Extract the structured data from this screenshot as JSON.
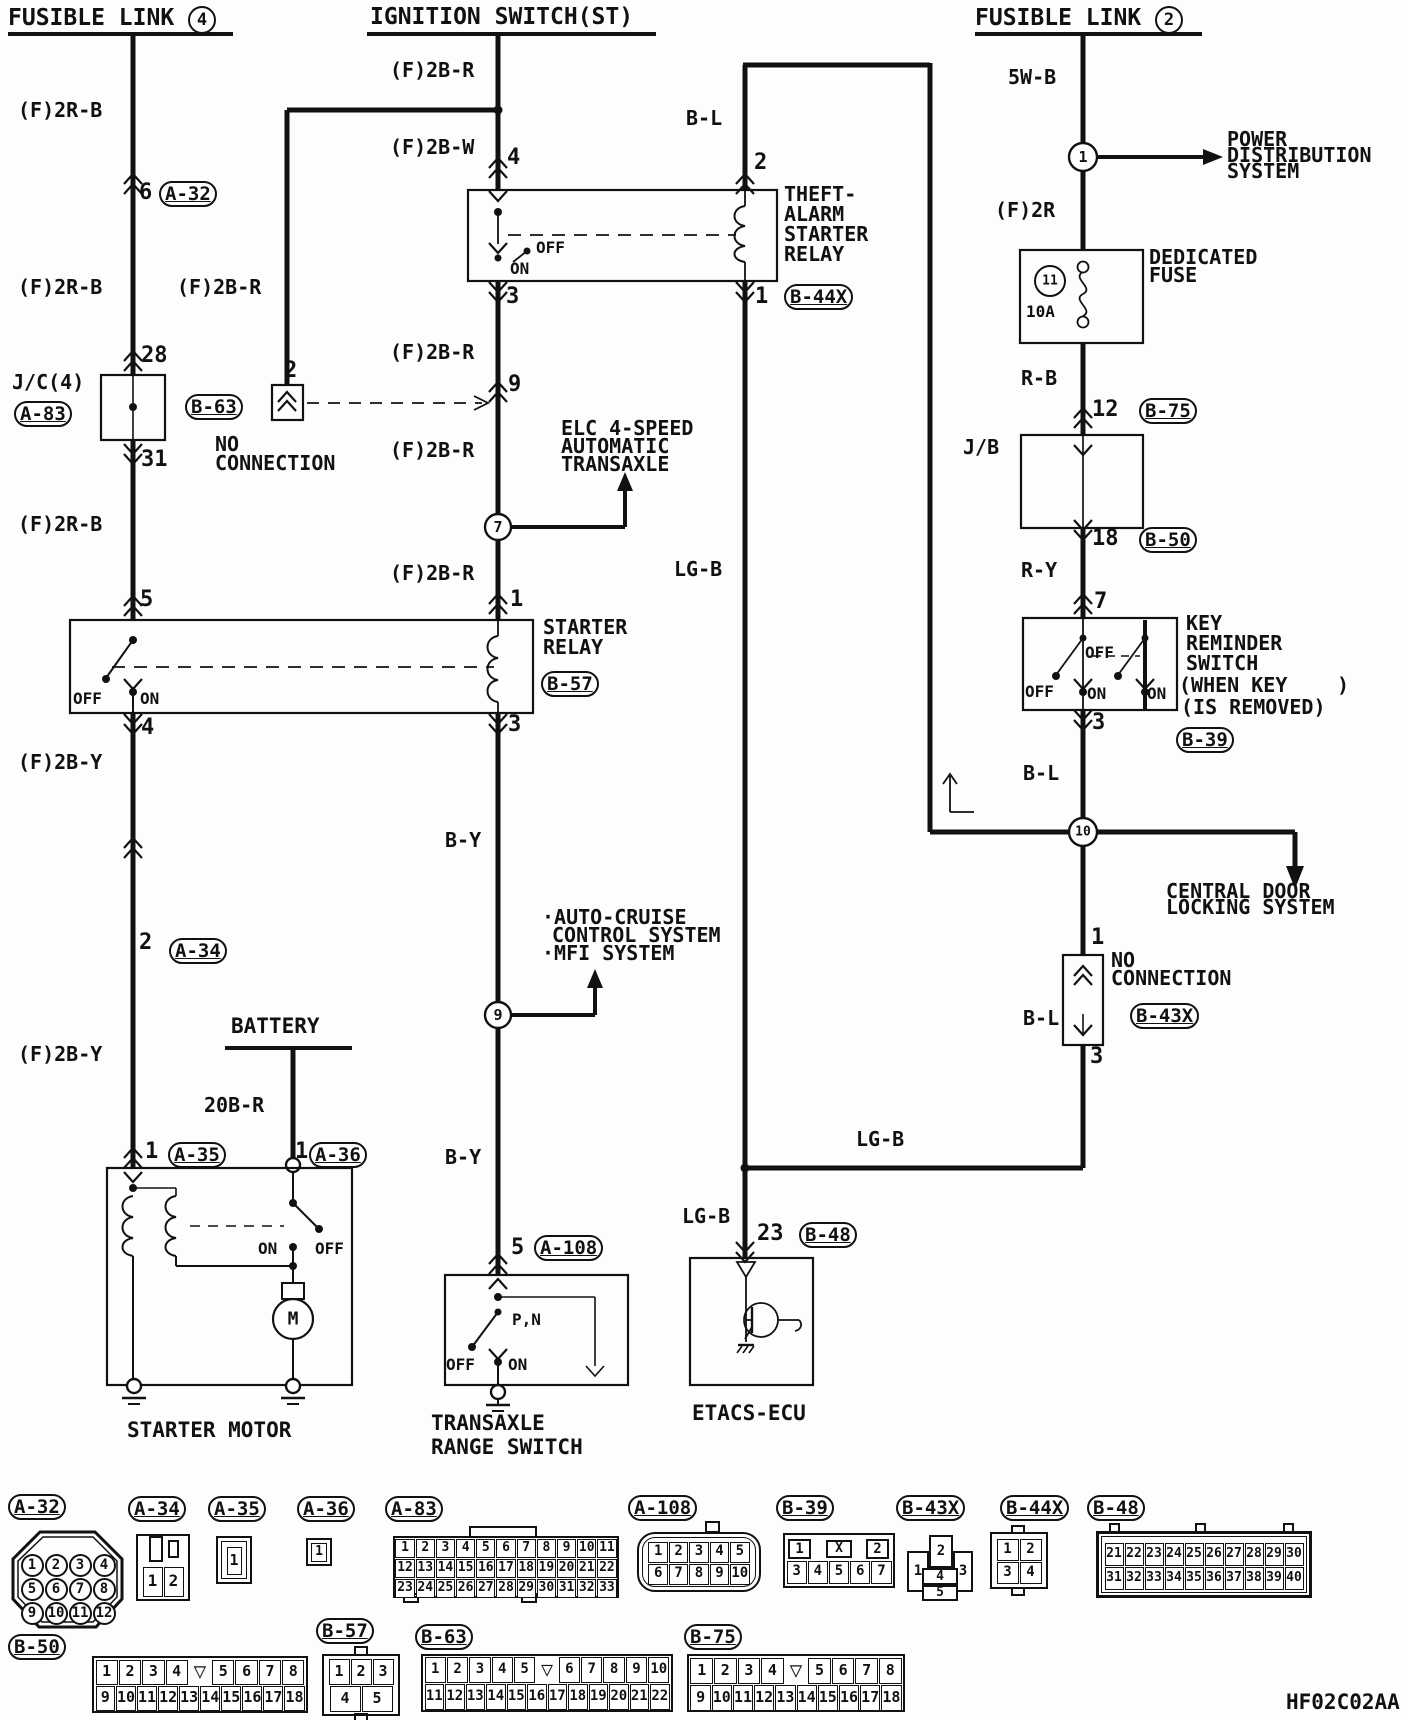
{
  "headers": {
    "left_text": "FUSIBLE LINK ",
    "left_num": "4",
    "center": "IGNITION SWITCH(ST)",
    "right_text": "FUSIBLE LINK ",
    "right_num": "2"
  },
  "left": {
    "w1": "(F)2R-B",
    "pin6": "6",
    "ref_a32": "A-32",
    "w2": "(F)2R-B",
    "wbranch": "(F)2B-R",
    "pin28": "28",
    "jc": "J/C(4)",
    "ref_a83": "A-83",
    "pin31": "31",
    "w3": "(F)2R-B",
    "pin5": "5",
    "relay_off": "OFF",
    "relay_on": "ON",
    "pin4": "4",
    "w4": "(F)2B-Y",
    "pin2": "2",
    "ref_a34": "A-34",
    "w5": "(F)2B-Y",
    "battery": "BATTERY",
    "w20br": "20B-R",
    "pin1a": "1",
    "ref_a35": "A-35",
    "pin1b": "1",
    "ref_a36": "A-36",
    "motor_on": "ON",
    "motor_off": "OFF",
    "motor_m": "M",
    "name": "STARTER MOTOR"
  },
  "middle": {
    "w_ign1": "(F)2B-R",
    "w_ign2": "(F)2B-W",
    "pin4": "4",
    "pin2_b63": "2",
    "ref_b63": "B-63",
    "nc1": "NO",
    "nc2": "CONNECTION",
    "bl": "B-L",
    "theft_pin2": "2",
    "tn1": "THEFT-",
    "tn2": "ALARM",
    "tn3": "STARTER",
    "tn4": "RELAY",
    "theft_off": "OFF",
    "theft_on": "ON",
    "theft_pin3": "3",
    "theft_pin1": "1",
    "ref_b44x": "B-44X",
    "w1": "(F)2B-R",
    "pin9": "9",
    "w2": "(F)2B-R",
    "elc1": "ELC 4-SPEED",
    "elc2": "AUTOMATIC",
    "elc3": "TRANSAXLE",
    "j7": "7",
    "w3": "(F)2B-R",
    "pin1": "1",
    "sr1": "STARTER",
    "sr2": "RELAY",
    "ref_b57": "B-57",
    "pin3": "3",
    "by1": "B-Y",
    "ac1": "·AUTO-CRUISE",
    "ac2": "CONTROL SYSTEM",
    "ac3": "·MFI SYSTEM",
    "j9": "9",
    "by2": "B-Y",
    "pin5": "5",
    "ref_a108": "A-108",
    "pn": "P,N",
    "tr_off": "OFF",
    "tr_on": "ON",
    "tr1": "TRANSAXLE",
    "tr2": "RANGE SWITCH",
    "lgb1": "LG-B",
    "lgb2": "LG-B",
    "lgb3": "LG-B",
    "pin23": "23",
    "ref_b48": "B-48",
    "etacs": "ETACS-ECU"
  },
  "right": {
    "w5wb": "5W-B",
    "j1": "1",
    "pd1": "POWER",
    "pd2": "DISTRIBUTION",
    "pd3": "SYSTEM",
    "w2r": "(F)2R",
    "j11": "11",
    "amp": "10A",
    "df1": "DEDICATED",
    "df2": "FUSE",
    "rb": "R-B",
    "pin12": "12",
    "ref_b75": "B-75",
    "jb": "J/B",
    "pin18": "18",
    "ref_b50": "B-50",
    "ry": "R-Y",
    "pin7": "7",
    "kr1": "KEY",
    "kr2": "REMINDER",
    "kr3": "SWITCH",
    "kr4": "(WHEN KEY",
    "kr4b": ")",
    "kr5": "(IS REMOVED)",
    "ref_b39": "B-39",
    "k_off_top": "OFF",
    "k_off": "OFF",
    "k_on1": "ON",
    "k_on2": "ON",
    "pin3": "3",
    "bl1": "B-L",
    "j10": "10",
    "cd1": "CENTRAL DOOR",
    "cd2": "LOCKING SYSTEM",
    "bl2": "B-L",
    "pin1": "1",
    "nc1": "NO",
    "nc2": "CONNECTION",
    "ref_b43x": "B-43X",
    "pin3b": "3"
  },
  "connectors": {
    "a32": {
      "label": "A-32",
      "rows": [
        [
          "1",
          "2",
          "3",
          "4"
        ],
        [
          "5",
          "6",
          "7",
          "8"
        ],
        [
          "9",
          "10",
          "11",
          "12"
        ]
      ]
    },
    "a34": {
      "label": "A-34",
      "rows": [
        [
          "1",
          "2"
        ]
      ]
    },
    "a35": {
      "label": "A-35",
      "rows": [
        [
          "1"
        ]
      ]
    },
    "a36": {
      "label": "A-36",
      "rows": [
        [
          "1"
        ]
      ]
    },
    "a83": {
      "label": "A-83",
      "rows": [
        [
          "1",
          "2",
          "3",
          "4",
          "5",
          "6",
          "7",
          "8",
          "9",
          "10",
          "11"
        ],
        [
          "12",
          "13",
          "14",
          "15",
          "16",
          "17",
          "18",
          "19",
          "20",
          "21",
          "22"
        ],
        [
          "23",
          "24",
          "25",
          "26",
          "27",
          "28",
          "29",
          "30",
          "31",
          "32",
          "33"
        ]
      ]
    },
    "a108": {
      "label": "A-108",
      "rows": [
        [
          "1",
          "2",
          "3",
          "4",
          "5"
        ],
        [
          "6",
          "7",
          "8",
          "9",
          "10"
        ]
      ]
    },
    "b39": {
      "label": "B-39",
      "rows": [
        [
          "1",
          "X",
          "2"
        ],
        [
          "3",
          "4",
          "5",
          "6",
          "7"
        ]
      ]
    },
    "b43x": {
      "label": "B-43X",
      "pins": [
        "1",
        "2",
        "3",
        "4",
        "5"
      ]
    },
    "b44x": {
      "label": "B-44X",
      "rows": [
        [
          "1",
          "2"
        ],
        [
          "3",
          "4"
        ]
      ]
    },
    "b48": {
      "label": "B-48",
      "rows": [
        [
          "21",
          "22",
          "23",
          "24",
          "25",
          "26",
          "27",
          "28",
          "29",
          "30"
        ],
        [
          "31",
          "32",
          "33",
          "34",
          "35",
          "36",
          "37",
          "38",
          "39",
          "40"
        ]
      ]
    },
    "b50": {
      "label": "B-50",
      "rows": [
        [
          "1",
          "2",
          "3",
          "4",
          "▽",
          "5",
          "6",
          "7",
          "8"
        ],
        [
          "9",
          "10",
          "11",
          "12",
          "13",
          "14",
          "15",
          "16",
          "17",
          "18"
        ]
      ]
    },
    "b57": {
      "label": "B-57",
      "rows": [
        [
          "1",
          "2",
          "3"
        ],
        [
          "4",
          "5"
        ]
      ]
    },
    "b63": {
      "label": "B-63",
      "rows": [
        [
          "1",
          "2",
          "3",
          "4",
          "5",
          "▽",
          "6",
          "7",
          "8",
          "9",
          "10"
        ],
        [
          "11",
          "12",
          "13",
          "14",
          "15",
          "16",
          "17",
          "18",
          "19",
          "20",
          "21",
          "22"
        ]
      ]
    },
    "b75": {
      "label": "B-75",
      "rows": [
        [
          "1",
          "2",
          "3",
          "4",
          "▽",
          "5",
          "6",
          "7",
          "8"
        ],
        [
          "9",
          "10",
          "11",
          "12",
          "13",
          "14",
          "15",
          "16",
          "17",
          "18"
        ]
      ]
    }
  },
  "code": "HF02C02AA"
}
